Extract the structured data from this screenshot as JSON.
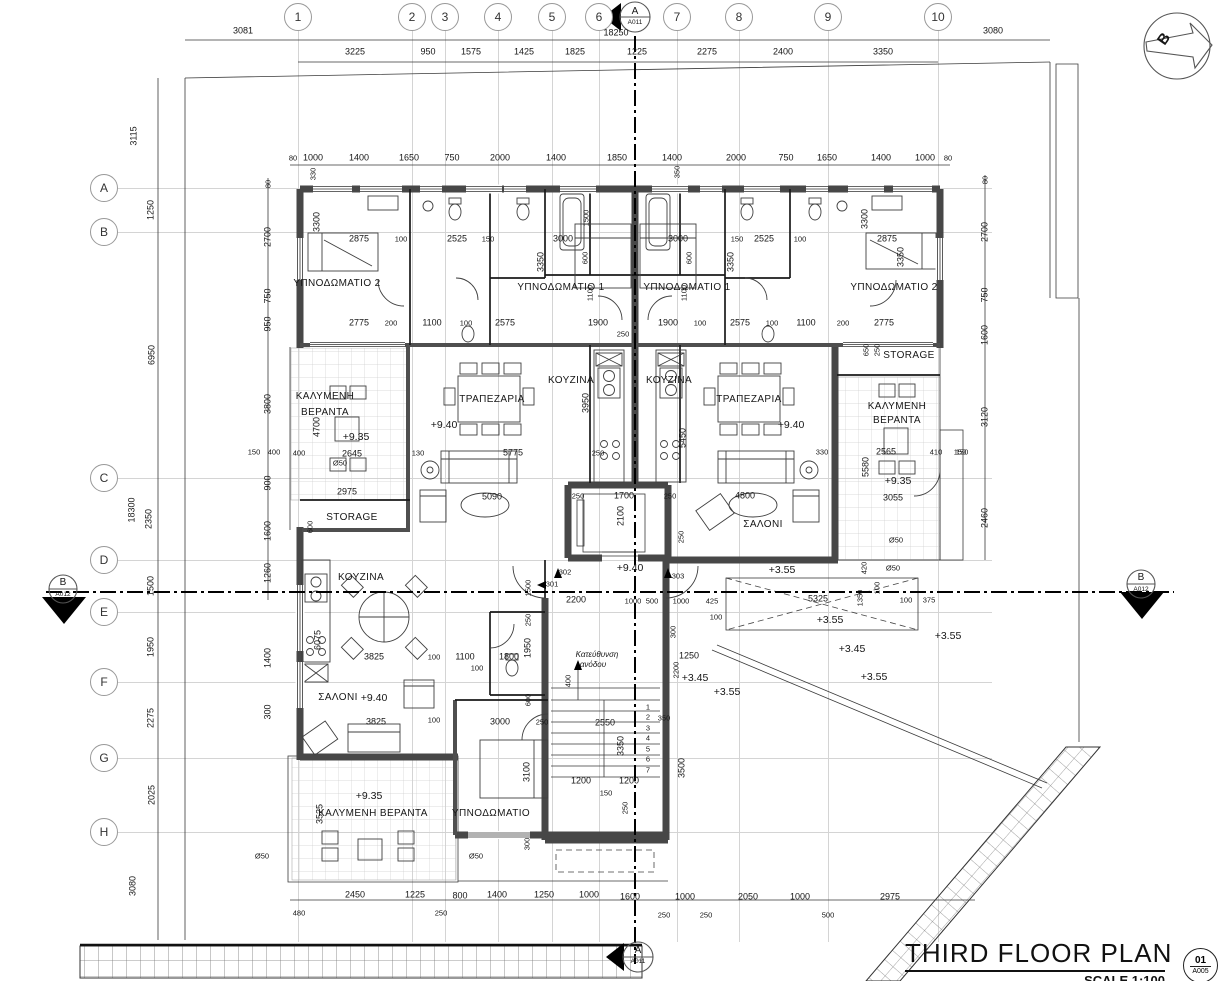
{
  "sheet_title": {
    "title": "THIRD FLOOR PLAN",
    "scale": "SCALE 1:100",
    "number": "01",
    "code": "A005"
  },
  "grid": {
    "columns": [
      [
        "1",
        298
      ],
      [
        "2",
        412
      ],
      [
        "3",
        445
      ],
      [
        "4",
        498
      ],
      [
        "5",
        552
      ],
      [
        "6",
        599
      ],
      [
        "7",
        677
      ],
      [
        "8",
        739
      ],
      [
        "9",
        828
      ],
      [
        "10",
        938
      ]
    ],
    "rows": [
      [
        "A",
        188
      ],
      [
        "B",
        232
      ],
      [
        "C",
        478
      ],
      [
        "D",
        560
      ],
      [
        "E",
        612
      ],
      [
        "F",
        682
      ],
      [
        "G",
        758
      ],
      [
        "H",
        832
      ]
    ]
  },
  "labels": [
    [
      "3081",
      243,
      31,
      "d"
    ],
    [
      "18250",
      616,
      33,
      "d"
    ],
    [
      "3080",
      993,
      31,
      "d"
    ],
    [
      "3225",
      355,
      52,
      "d"
    ],
    [
      "950",
      428,
      52,
      "d"
    ],
    [
      "1575",
      471,
      52,
      "d"
    ],
    [
      "1425",
      524,
      52,
      "d"
    ],
    [
      "1825",
      575,
      52,
      "d"
    ],
    [
      "1225",
      637,
      52,
      "d"
    ],
    [
      "2275",
      707,
      52,
      "d"
    ],
    [
      "2400",
      783,
      52,
      "d"
    ],
    [
      "3350",
      883,
      52,
      "d"
    ],
    [
      "80",
      293,
      158,
      "s"
    ],
    [
      "1000",
      313,
      158,
      "d"
    ],
    [
      "1400",
      359,
      158,
      "d"
    ],
    [
      "1650",
      409,
      158,
      "d"
    ],
    [
      "750",
      452,
      158,
      "d"
    ],
    [
      "2000",
      500,
      158,
      "d"
    ],
    [
      "1400",
      556,
      158,
      "d"
    ],
    [
      "1850",
      617,
      158,
      "d"
    ],
    [
      "1400",
      672,
      158,
      "d"
    ],
    [
      "2000",
      736,
      158,
      "d"
    ],
    [
      "750",
      786,
      158,
      "d"
    ],
    [
      "1650",
      827,
      158,
      "d"
    ],
    [
      "1400",
      881,
      158,
      "d"
    ],
    [
      "1000",
      925,
      158,
      "d"
    ],
    [
      "80",
      948,
      158,
      "s"
    ],
    [
      "330",
      313,
      174,
      "rs"
    ],
    [
      "350",
      677,
      172,
      "rs"
    ],
    [
      "3115",
      134,
      136,
      "r"
    ],
    [
      "1250",
      151,
      210,
      "r"
    ],
    [
      "6950",
      152,
      355,
      "r"
    ],
    [
      "18300",
      132,
      510,
      "r"
    ],
    [
      "2350",
      149,
      519,
      "r"
    ],
    [
      "1500",
      151,
      586,
      "r"
    ],
    [
      "1950",
      151,
      647,
      "r"
    ],
    [
      "2275",
      151,
      718,
      "r"
    ],
    [
      "2025",
      152,
      795,
      "r"
    ],
    [
      "3080",
      133,
      886,
      "r"
    ],
    [
      "80",
      268,
      184,
      "rs"
    ],
    [
      "2700",
      268,
      237,
      "r"
    ],
    [
      "750",
      268,
      296,
      "r"
    ],
    [
      "950",
      268,
      324,
      "r"
    ],
    [
      "3800",
      268,
      404,
      "r"
    ],
    [
      "150",
      254,
      452,
      "s"
    ],
    [
      "400",
      274,
      452,
      "s"
    ],
    [
      "900",
      268,
      483,
      "r"
    ],
    [
      "1600",
      268,
      531,
      "r"
    ],
    [
      "1260",
      268,
      573,
      "r"
    ],
    [
      "1400",
      268,
      658,
      "r"
    ],
    [
      "300",
      268,
      712,
      "r"
    ],
    [
      "80",
      985,
      180,
      "rs"
    ],
    [
      "2700",
      985,
      232,
      "r"
    ],
    [
      "750",
      985,
      295,
      "r"
    ],
    [
      "1600",
      985,
      335,
      "r"
    ],
    [
      "3120",
      985,
      417,
      "r"
    ],
    [
      "150",
      962,
      452,
      "s"
    ],
    [
      "2460",
      985,
      518,
      "r"
    ],
    [
      "2875",
      359,
      239,
      "d"
    ],
    [
      "100",
      401,
      239,
      "s"
    ],
    [
      "2525",
      457,
      239,
      "d"
    ],
    [
      "150",
      488,
      239,
      "s"
    ],
    [
      "3000",
      563,
      239,
      "d"
    ],
    [
      "3000",
      678,
      239,
      "d"
    ],
    [
      "150",
      737,
      239,
      "s"
    ],
    [
      "2525",
      764,
      239,
      "d"
    ],
    [
      "100",
      800,
      239,
      "s"
    ],
    [
      "2875",
      887,
      239,
      "d"
    ],
    [
      "3300",
      317,
      222,
      "r"
    ],
    [
      "3350",
      541,
      262,
      "r"
    ],
    [
      "3350",
      731,
      262,
      "r"
    ],
    [
      "3300",
      865,
      219,
      "r"
    ],
    [
      "3350",
      901,
      257,
      "r"
    ],
    [
      "1500",
      586,
      218,
      "rs"
    ],
    [
      "1100",
      590,
      293,
      "rs"
    ],
    [
      "1100",
      684,
      293,
      "rs"
    ],
    [
      "600",
      585,
      258,
      "rs"
    ],
    [
      "600",
      689,
      258,
      "rs"
    ],
    [
      "ΥΠΝΟΔΩΜΑΤΙΟ 2",
      337,
      284,
      "rm"
    ],
    [
      "ΥΠΝΟΔΩΜΑΤΙΟ 1",
      561,
      288,
      "rm"
    ],
    [
      "ΥΠΝΟΔΩΜΑΤΙΟ 1",
      687,
      288,
      "rm"
    ],
    [
      "ΥΠΝΟΔΩΜΑΤΙΟ 2",
      894,
      288,
      "rm"
    ],
    [
      "2775",
      359,
      323,
      "d"
    ],
    [
      "200",
      391,
      323,
      "s"
    ],
    [
      "1100",
      432,
      323,
      "d"
    ],
    [
      "100",
      466,
      323,
      "s"
    ],
    [
      "2575",
      505,
      323,
      "d"
    ],
    [
      "1900",
      598,
      323,
      "d"
    ],
    [
      "250",
      623,
      334,
      "s"
    ],
    [
      "1900",
      668,
      323,
      "d"
    ],
    [
      "100",
      700,
      323,
      "s"
    ],
    [
      "2575",
      740,
      323,
      "d"
    ],
    [
      "100",
      772,
      323,
      "s"
    ],
    [
      "1100",
      806,
      323,
      "d"
    ],
    [
      "200",
      843,
      323,
      "s"
    ],
    [
      "2775",
      884,
      323,
      "d"
    ],
    [
      "ΚΟΥΖΙΝΑ",
      571,
      381,
      "rm"
    ],
    [
      "ΚΟΥΖΙΝΑ",
      669,
      381,
      "rm"
    ],
    [
      "3950",
      586,
      403,
      "r"
    ],
    [
      "5450",
      683,
      438,
      "r"
    ],
    [
      "250",
      598,
      453,
      "s"
    ],
    [
      "ΤΡΑΠΕΖΑΡΙΑ",
      492,
      400,
      "rm"
    ],
    [
      "+9.40",
      444,
      425,
      "lv"
    ],
    [
      "ΤΡΑΠΕΖΑΡΙΑ",
      749,
      400,
      "rm"
    ],
    [
      "+9.40",
      791,
      425,
      "lv"
    ],
    [
      "ΚΑΛΥΜΕΝΗ",
      325,
      397,
      "rm"
    ],
    [
      "ΒΕΡΑΝΤΑ",
      325,
      413,
      "rm"
    ],
    [
      "+9.35",
      356,
      437,
      "lv"
    ],
    [
      "4700",
      317,
      427,
      "r"
    ],
    [
      "2645",
      352,
      454,
      "d"
    ],
    [
      "130",
      418,
      453,
      "s"
    ],
    [
      "5775",
      513,
      453,
      "d"
    ],
    [
      "400",
      299,
      453,
      "s"
    ],
    [
      "2975",
      347,
      492,
      "d"
    ],
    [
      "Ø50",
      340,
      463,
      "s"
    ],
    [
      "STORAGE",
      352,
      518,
      "rm"
    ],
    [
      "600",
      310,
      527,
      "rs"
    ],
    [
      "5090",
      492,
      497,
      "d"
    ],
    [
      "330",
      822,
      452,
      "s"
    ],
    [
      "2565",
      886,
      452,
      "d"
    ],
    [
      "410",
      936,
      452,
      "s"
    ],
    [
      "150",
      960,
      452,
      "s"
    ],
    [
      "5580",
      866,
      467,
      "r"
    ],
    [
      "+9.35",
      898,
      481,
      "lv"
    ],
    [
      "3055",
      893,
      498,
      "d"
    ],
    [
      "Ø50",
      896,
      540,
      "s"
    ],
    [
      "STORAGE",
      909,
      356,
      "rm"
    ],
    [
      "650",
      866,
      350,
      "rs"
    ],
    [
      "250",
      877,
      350,
      "rs"
    ],
    [
      "ΚΑΛΥΜΕΝΗ",
      897,
      407,
      "rm"
    ],
    [
      "ΒΕΡΑΝΤΑ",
      897,
      421,
      "rm"
    ],
    [
      "ΣΑΛΟΝΙ",
      763,
      525,
      "rm"
    ],
    [
      "4800",
      745,
      496,
      "d"
    ],
    [
      "250",
      578,
      496,
      "s"
    ],
    [
      "1700",
      624,
      496,
      "d"
    ],
    [
      "250",
      670,
      496,
      "s"
    ],
    [
      "2100",
      621,
      516,
      "r"
    ],
    [
      "250",
      681,
      537,
      "rs"
    ],
    [
      "+9.40",
      630,
      568,
      "lv"
    ],
    [
      "ΚΟΥΖΙΝΑ",
      361,
      578,
      "rm"
    ],
    [
      "6075",
      318,
      640,
      "r"
    ],
    [
      "3825",
      374,
      657,
      "d"
    ],
    [
      "100",
      434,
      657,
      "s"
    ],
    [
      "1100",
      465,
      657,
      "d"
    ],
    [
      "100",
      477,
      668,
      "s"
    ],
    [
      "1800",
      509,
      657,
      "d"
    ],
    [
      "1950",
      528,
      648,
      "r"
    ],
    [
      "1500",
      528,
      588,
      "rs"
    ],
    [
      "250",
      528,
      620,
      "rs"
    ],
    [
      "302",
      565,
      572,
      "s"
    ],
    [
      "301",
      552,
      584,
      "s"
    ],
    [
      "303",
      678,
      576,
      "s"
    ],
    [
      "2200",
      576,
      600,
      "d"
    ],
    [
      "1000",
      633,
      601,
      "s"
    ],
    [
      "500",
      652,
      601,
      "s"
    ],
    [
      "1000",
      681,
      601,
      "s"
    ],
    [
      "425",
      712,
      601,
      "s"
    ],
    [
      "100",
      716,
      617,
      "s"
    ],
    [
      "ΣΑΛΟΝΙ",
      338,
      698,
      "rm"
    ],
    [
      "+9.40",
      374,
      698,
      "lv"
    ],
    [
      "3825",
      376,
      722,
      "d"
    ],
    [
      "100",
      434,
      720,
      "s"
    ],
    [
      "3000",
      500,
      722,
      "d"
    ],
    [
      "250",
      542,
      722,
      "s"
    ],
    [
      "600",
      528,
      700,
      "rs"
    ],
    [
      "1250",
      689,
      656,
      "d"
    ],
    [
      "2200",
      676,
      670,
      "rs"
    ],
    [
      "300",
      673,
      632,
      "rs"
    ],
    [
      "+3.45",
      695,
      678,
      "lv"
    ],
    [
      "+3.55",
      727,
      692,
      "lv"
    ],
    [
      "350",
      664,
      718,
      "s"
    ],
    [
      "3500",
      682,
      768,
      "r"
    ],
    [
      "2550",
      605,
      723,
      "d"
    ],
    [
      "3350",
      621,
      746,
      "r"
    ],
    [
      "1200",
      581,
      781,
      "d"
    ],
    [
      "1200",
      629,
      781,
      "d"
    ],
    [
      "150",
      606,
      793,
      "s"
    ],
    [
      "250",
      625,
      808,
      "rs"
    ],
    [
      "400",
      568,
      681,
      "rs"
    ],
    [
      "1",
      648,
      707,
      "s"
    ],
    [
      "2",
      648,
      717,
      "s"
    ],
    [
      "3",
      648,
      728,
      "s"
    ],
    [
      "4",
      648,
      738,
      "s"
    ],
    [
      "5",
      648,
      749,
      "s"
    ],
    [
      "6",
      648,
      759,
      "s"
    ],
    [
      "7",
      648,
      770,
      "s"
    ],
    [
      "Κατεύθυνση",
      597,
      655,
      "it"
    ],
    [
      "ανόδου",
      593,
      665,
      "it"
    ],
    [
      "ΚΑΛΥΜΕΝΗ ΒΕΡΑΝΤΑ",
      373,
      814,
      "rm"
    ],
    [
      "+9.35",
      369,
      796,
      "lv"
    ],
    [
      "3525",
      320,
      814,
      "r"
    ],
    [
      "Ø50",
      262,
      856,
      "s"
    ],
    [
      "Ø50",
      476,
      856,
      "s"
    ],
    [
      "ΥΠΝΟΔΩΜΑΤΙΟ",
      491,
      814,
      "rm"
    ],
    [
      "3100",
      527,
      772,
      "r"
    ],
    [
      "300",
      527,
      844,
      "rs"
    ],
    [
      "+3.55",
      782,
      570,
      "lv"
    ],
    [
      "5325",
      818,
      599,
      "d"
    ],
    [
      "1350",
      860,
      598,
      "rs"
    ],
    [
      "100",
      877,
      588,
      "rs"
    ],
    [
      "100",
      906,
      600,
      "s"
    ],
    [
      "375",
      929,
      600,
      "s"
    ],
    [
      "420",
      864,
      568,
      "rs"
    ],
    [
      "+3.55",
      830,
      620,
      "lv"
    ],
    [
      "+3.45",
      852,
      649,
      "lv"
    ],
    [
      "+3.55",
      874,
      677,
      "lv"
    ],
    [
      "+3.55",
      948,
      636,
      "lv"
    ],
    [
      "Ø50",
      893,
      568,
      "s"
    ],
    [
      "2450",
      355,
      895,
      "d"
    ],
    [
      "1225",
      415,
      895,
      "d"
    ],
    [
      "800",
      460,
      896,
      "d"
    ],
    [
      "1400",
      497,
      895,
      "d"
    ],
    [
      "1250",
      544,
      895,
      "d"
    ],
    [
      "1000",
      589,
      895,
      "d"
    ],
    [
      "1600",
      630,
      897,
      "d"
    ],
    [
      "1000",
      685,
      897,
      "d"
    ],
    [
      "2050",
      748,
      897,
      "d"
    ],
    [
      "1000",
      800,
      897,
      "d"
    ],
    [
      "2975",
      890,
      897,
      "d"
    ],
    [
      "480",
      299,
      913,
      "s"
    ],
    [
      "250",
      441,
      913,
      "s"
    ],
    [
      "250",
      664,
      915,
      "s"
    ],
    [
      "250",
      706,
      915,
      "s"
    ],
    [
      "500",
      828,
      915,
      "s"
    ],
    [
      "A",
      635,
      12,
      "mk"
    ],
    [
      "A011",
      635,
      23,
      "mks"
    ],
    [
      "A",
      638,
      951,
      "mk"
    ],
    [
      "A011",
      638,
      962,
      "mks"
    ],
    [
      "B",
      63,
      583,
      "mk"
    ],
    [
      "A012",
      63,
      595,
      "mks"
    ],
    [
      "B",
      1141,
      578,
      "mk"
    ],
    [
      "A012",
      1141,
      590,
      "mks"
    ],
    [
      "B",
      1164,
      39,
      "n"
    ]
  ]
}
